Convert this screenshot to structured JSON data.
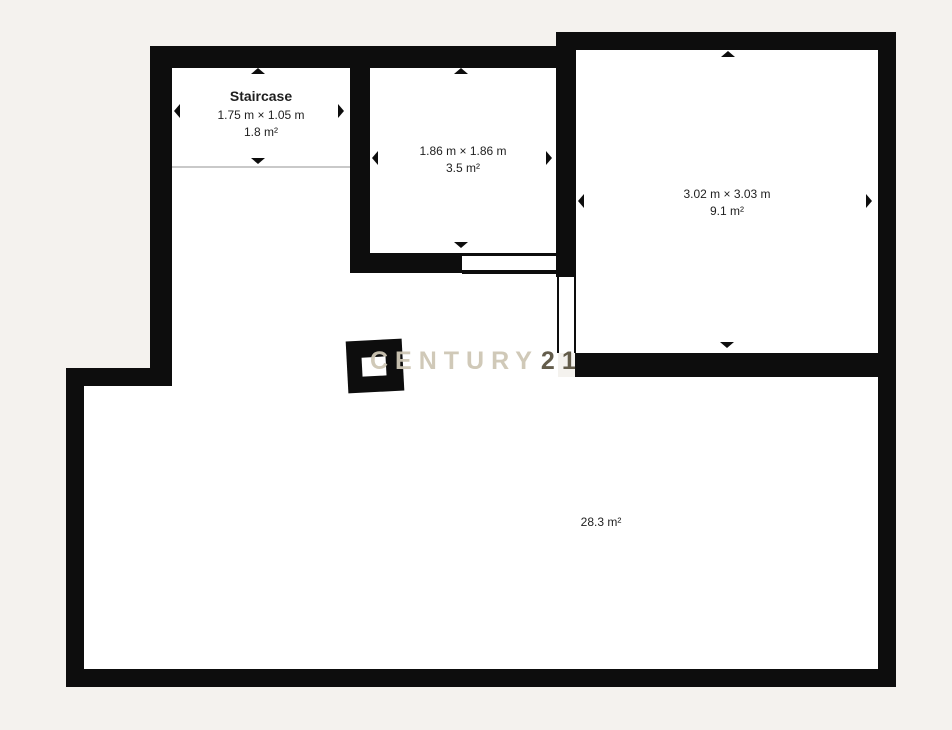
{
  "plan": {
    "rooms": {
      "staircase": {
        "label": "Staircase",
        "dimensions": "1.75 m × 1.05 m",
        "area": "1.8 m²"
      },
      "room2": {
        "dimensions": "1.86 m × 1.86 m",
        "area": "3.5 m²"
      },
      "room3": {
        "dimensions": "3.02 m × 3.03 m",
        "area": "9.1 m²"
      },
      "main": {
        "area": "28.3 m²"
      }
    },
    "watermark": {
      "brand": "CENTURY",
      "number": "21"
    },
    "colors": {
      "background": "#f4f2ee",
      "wall": "#0d0d0d",
      "room_fill": "#ffffff",
      "text": "#1f1f1f",
      "divider_line": "#c9c9c9",
      "watermark_light": "#cec7b5",
      "watermark_dark": "#57503d"
    }
  }
}
